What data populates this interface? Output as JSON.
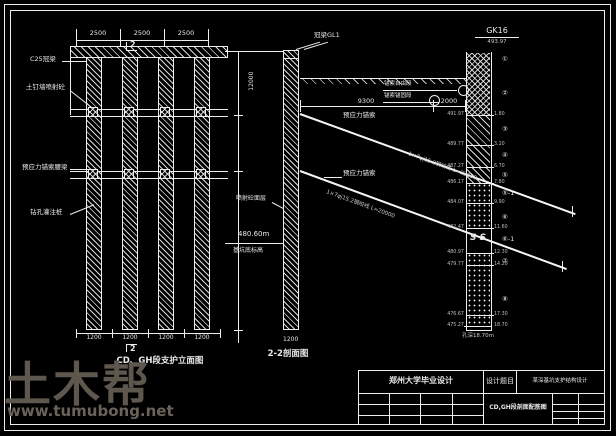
{
  "watermark": {
    "brand": "土木帮",
    "site": "www.tumubong.net"
  },
  "plan": {
    "title": "CD、GH段支护立面图",
    "section_marker": "2",
    "top_dims": [
      "2500",
      "2500",
      "2500"
    ],
    "bottom_dims": [
      "1200",
      "1200",
      "1200",
      "1200"
    ],
    "labels": {
      "cap_beam": "C25冠梁",
      "soil_nail_wall": "土钉墙喷射砼",
      "anchor_waler": "预应力锚索腰梁",
      "bored_pile": "钻孔灌注桩"
    }
  },
  "section": {
    "title": "2-2剖面图",
    "height_dim": "12000",
    "dim_9300": "9300",
    "dim_2000": "2000",
    "crown_beam": "冠梁GL1",
    "free_length": "锚索自由段",
    "bond_length": "锚索锚固段",
    "anchor_label_1": "预应力锚索",
    "anchor_label_2": "预应力锚索",
    "anchor_note_1": "1×7φj15.2钢绞线 L=22000",
    "anchor_note_2": "1×7φj15.2钢绞线 L=20000",
    "face_label": "喷射砼面层",
    "pit_elevation": "480.60m",
    "pit_label": "基坑底标高",
    "pile_spacing": "1200"
  },
  "borehole": {
    "name": "GK16",
    "ground_elevation": "493.97",
    "bottom_note": "孔深18.70m",
    "ss_symbol": "S S",
    "boundaries": [
      {
        "elev": "491.97",
        "depth": "1.80"
      },
      {
        "elev": "489.77",
        "depth": "3.20"
      },
      {
        "elev": "487.27",
        "depth": "6.70"
      },
      {
        "elev": "486.17",
        "depth": "7.80"
      },
      {
        "elev": "484.07",
        "depth": "9.90"
      },
      {
        "elev": "482.47",
        "depth": "11.60"
      },
      {
        "elev": "480.97",
        "depth": "12.30"
      },
      {
        "elev": "479.77",
        "depth": "14.20"
      },
      {
        "elev": "476.67",
        "depth": "17.30"
      },
      {
        "elev": "475.27",
        "depth": "18.70"
      }
    ],
    "layers": [
      "①",
      "②",
      "③",
      "④",
      "⑤",
      "⑤-1",
      "⑥",
      "⑥-1",
      "⑦",
      "⑧"
    ]
  },
  "titleblock": {
    "school": "郑州大学毕业设计",
    "subject_label": "设计题目",
    "subject": "某深基坑支护结构设计",
    "drawing_name": "CD,GH段剖面配筋图"
  }
}
